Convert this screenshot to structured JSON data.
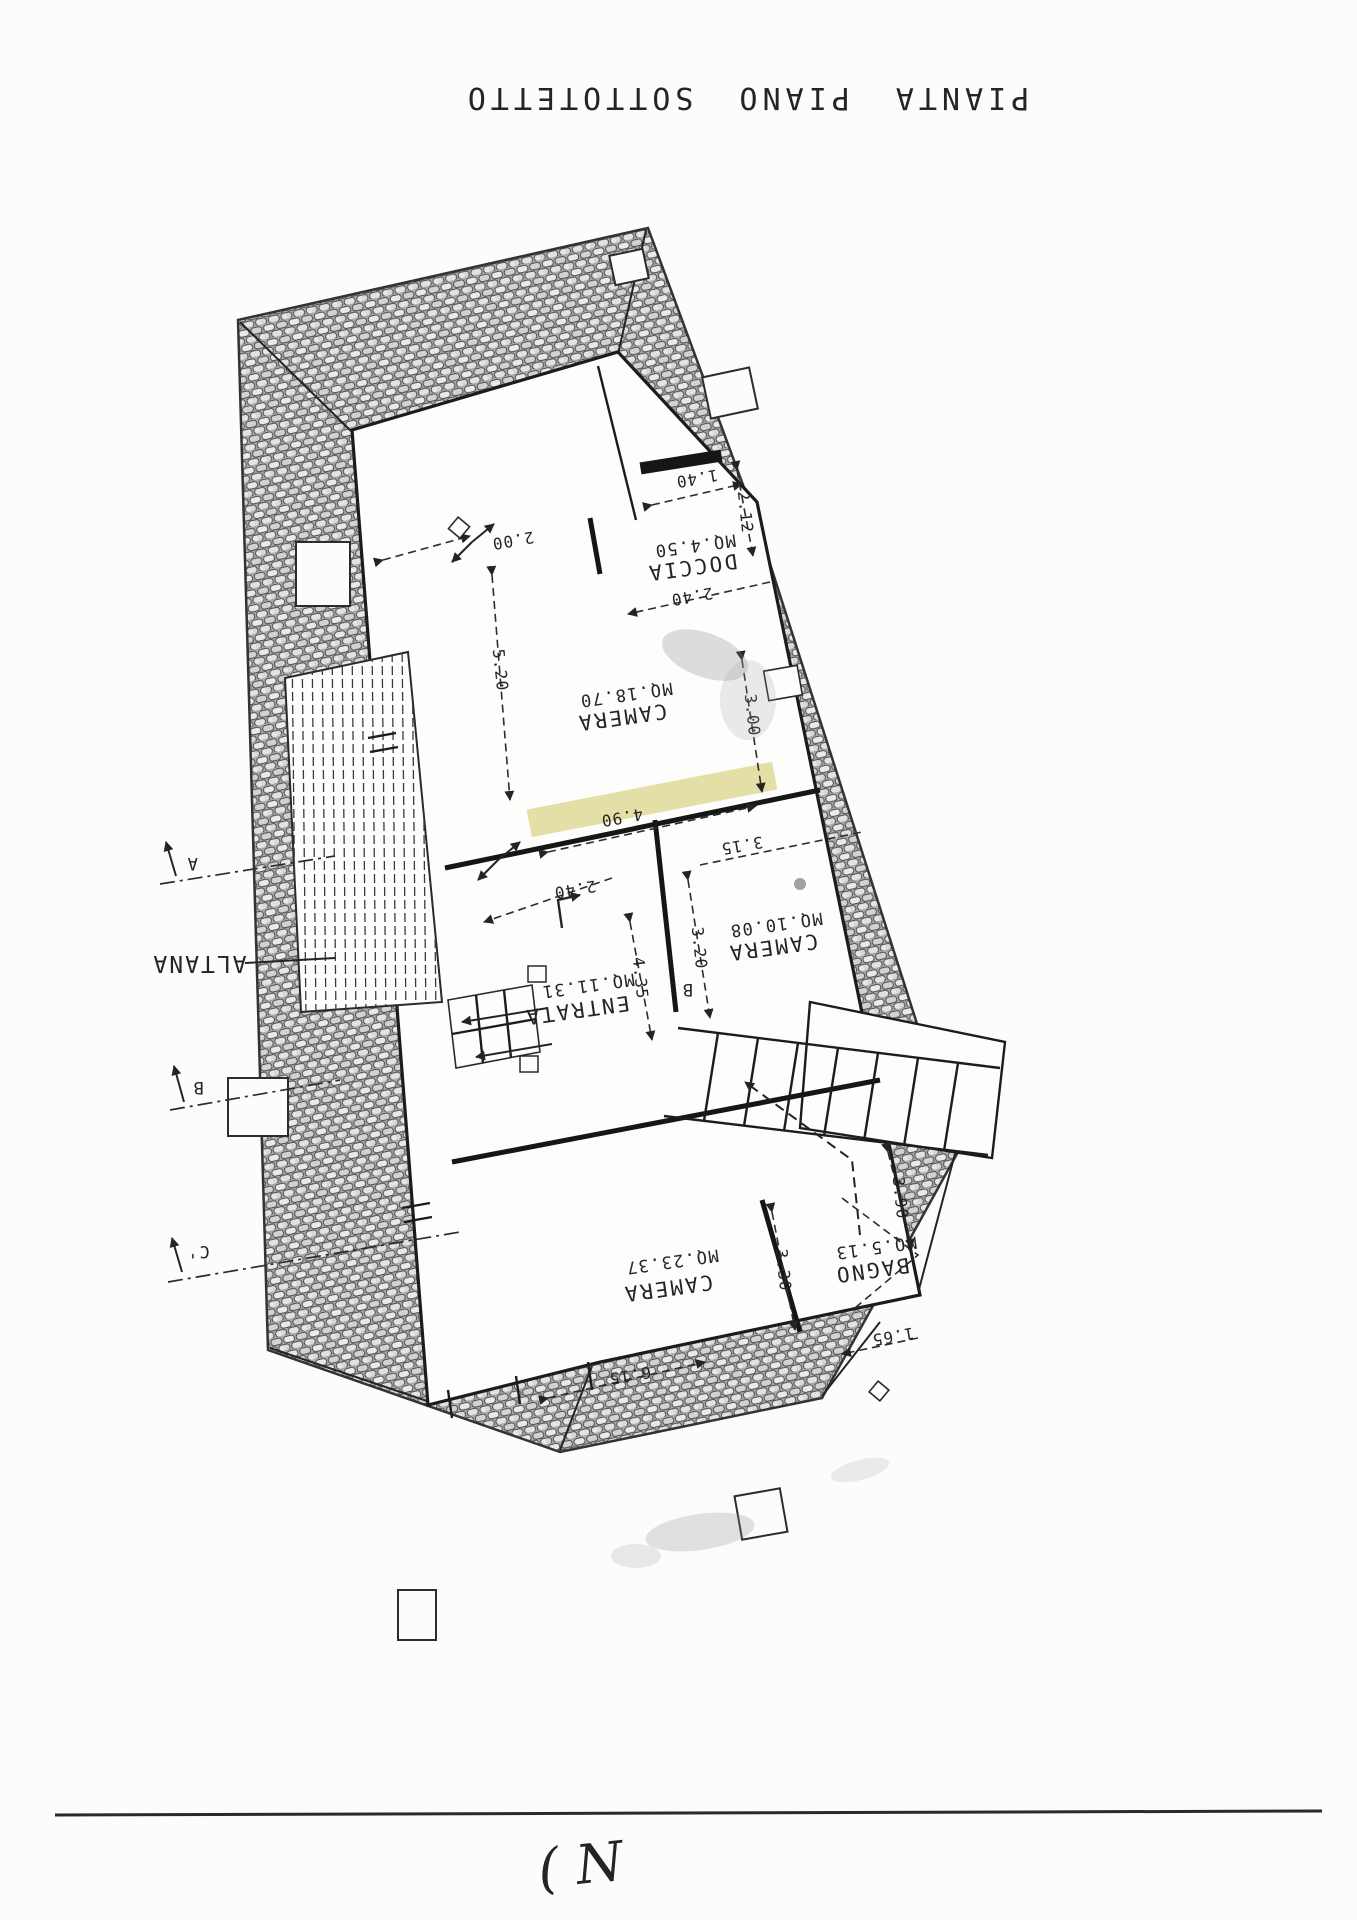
{
  "page": {
    "title": "PIANTA PIANO SOTTOTETTO",
    "handwritten_note": "( N",
    "colors": {
      "paper": "#fcfcfa",
      "ink": "#242424",
      "roof_tile_gray": "#a9a9a9",
      "highlight_yellow": "#c9c24f"
    }
  },
  "rooms": [
    {
      "name": "CAMERA",
      "area": "MQ.18.70"
    },
    {
      "name": "DOCCIA",
      "area": "MQ.4.50"
    },
    {
      "name": "ENTRATA",
      "area": "MQ.11.31"
    },
    {
      "name": "CAMERA",
      "area": "MQ.10.08"
    },
    {
      "name": "CAMERA",
      "area": "MQ.23.37"
    },
    {
      "name": "BAGNO",
      "area": "MQ.5.13"
    }
  ],
  "outdoor_label": "ALTANA",
  "section_markers": {
    "a": "A",
    "b": "B",
    "c": "C'",
    "interior_b": "B"
  },
  "dimensions": {
    "d200": "2.00",
    "d520": "5.20",
    "d140": "1.40",
    "d212": "2.12",
    "d240a": "2.40",
    "d300": "3.00",
    "d490": "4.90",
    "d315": "3.15",
    "d240b": "2.40",
    "d435": "4.35",
    "d320": "3.20",
    "d330": "3.30",
    "d615": "6.15",
    "d165": "1.65",
    "d390": "3.90"
  }
}
